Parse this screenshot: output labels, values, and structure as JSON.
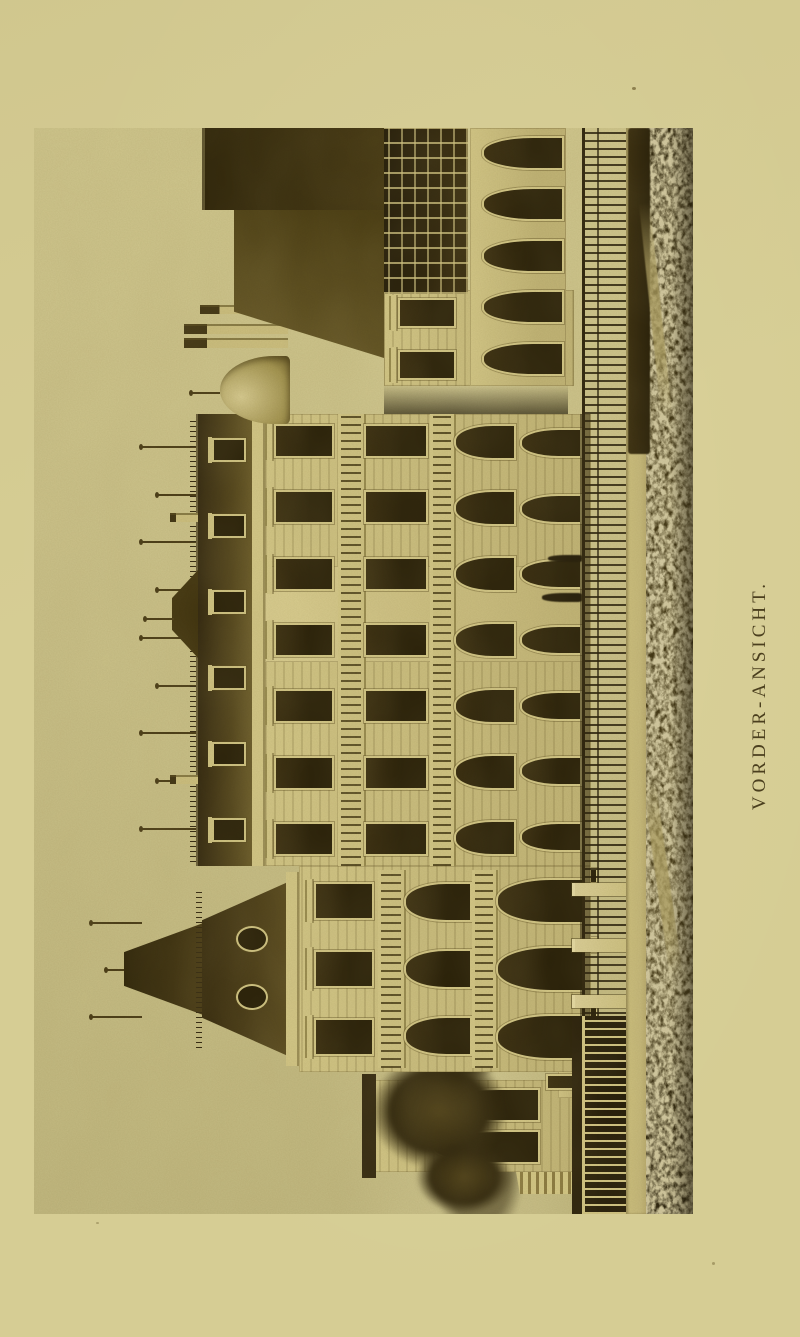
{
  "figure": {
    "caption": "VORDER-ANSICHT."
  },
  "colors": {
    "paper": "#d6cd94",
    "photo_sky_top": "#c2b981",
    "photo_sky_low": "#ccc38b",
    "wall": "#c2b577",
    "wall_light": "#d4c888",
    "wall_shadow": "#998c50",
    "opening": "#2b2209",
    "deep_shadow": "#1d1706",
    "roof": "#55471d",
    "roof_dark": "#342910",
    "balustrade": "#d0c484",
    "fence": "#2e240c",
    "path": "#c7ba7c",
    "lawn": "#413612",
    "lawn_light": "#ab9d61",
    "caption": "#4b3f1e"
  }
}
